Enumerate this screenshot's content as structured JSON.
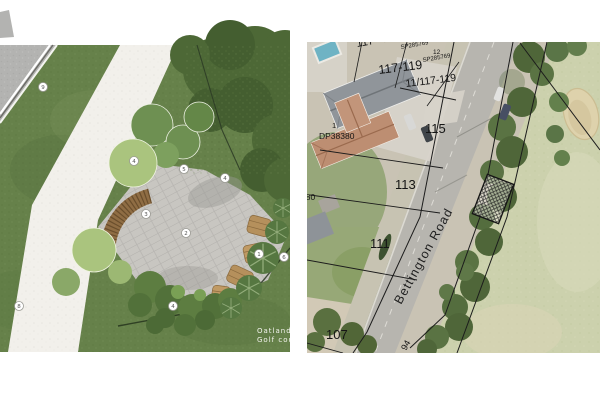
{
  "left_panel": {
    "credit": {
      "line1": "Oatlands",
      "line2": "Golf course"
    },
    "markers": [
      {
        "n": "9"
      },
      {
        "n": "4"
      },
      {
        "n": "5"
      },
      {
        "n": "4"
      },
      {
        "n": "3"
      },
      {
        "n": "2"
      },
      {
        "n": "1"
      },
      {
        "n": "6"
      },
      {
        "n": "4"
      },
      {
        "n": "8"
      }
    ]
  },
  "right_panel": {
    "road_name": "Bettington Road",
    "dimension_label": "94",
    "labels": [
      {
        "text": "117 - 119"
      },
      {
        "text": "SP285769"
      },
      {
        "text": "12"
      },
      {
        "text": "SP285769"
      },
      {
        "text": "117-119"
      },
      {
        "text": "11/117-119"
      },
      {
        "text": "115"
      },
      {
        "text": "1"
      },
      {
        "text": "DP38380"
      },
      {
        "text": "113"
      },
      {
        "text": "380"
      },
      {
        "text": "111"
      },
      {
        "text": "107"
      }
    ]
  },
  "colors": {
    "grass": "#66814a",
    "plan_road": "#b3b3b1",
    "path": "#f2f0eb",
    "paving": "#c8c6c1",
    "bench_wood": "#8f6d44",
    "aerial_road": "#b7b5af",
    "golf_green": "#ccd1ad",
    "roof_gray": "#90959a",
    "roof_terracotta": "#bd8e72",
    "pool_blue": "#6fb3c4"
  }
}
